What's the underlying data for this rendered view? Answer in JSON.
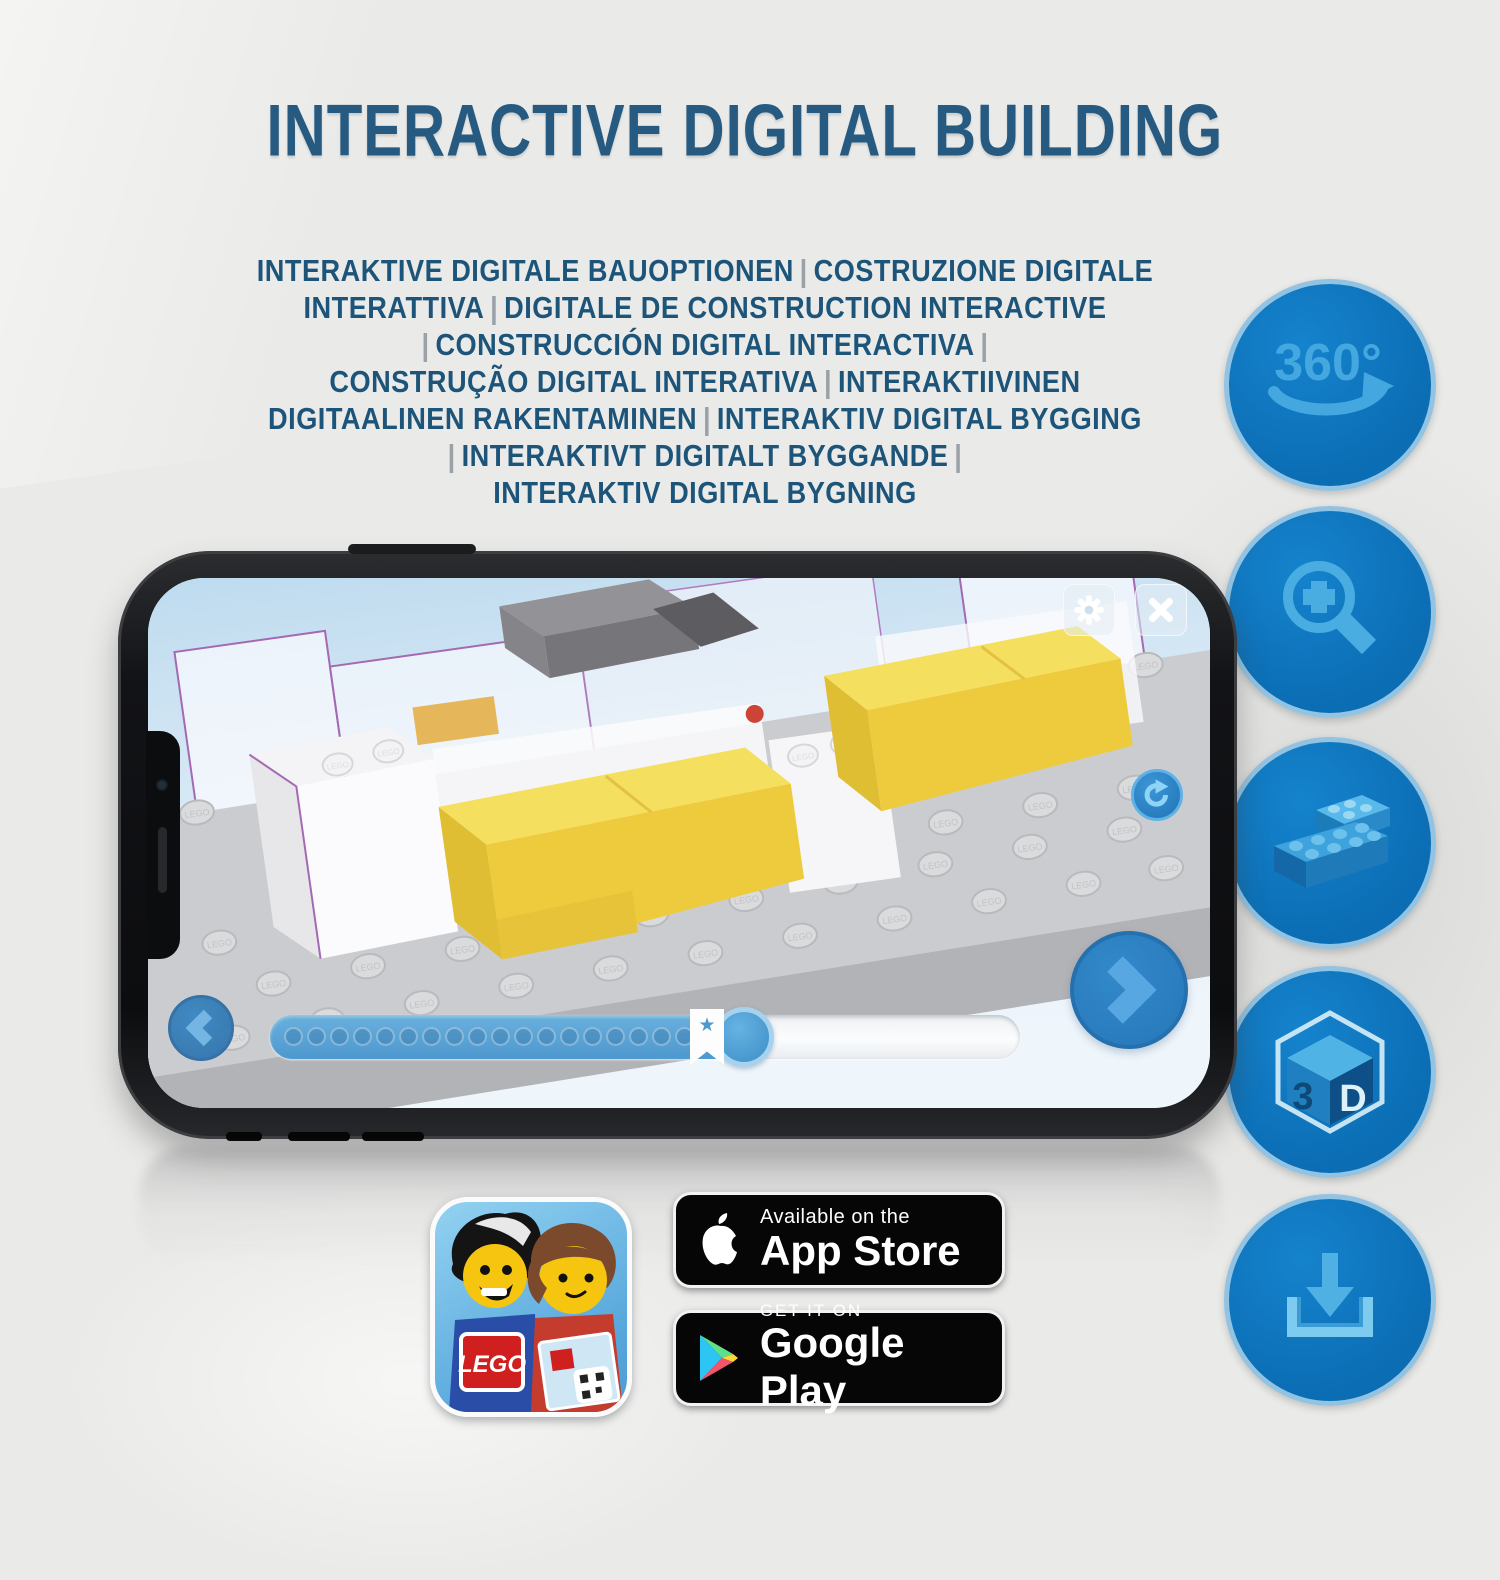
{
  "title": "INTERACTIVE DIGITAL BUILDING",
  "subtitle_lines": [
    "INTERAKTIVE DIGITALE BAUOPTIONEN | COSTRUZIONE DIGITALE",
    "INTERATTIVA | DIGITALE DE CONSTRUCTION INTERACTIVE",
    "| CONSTRUCCIÓN DIGITAL INTERACTIVA |",
    "CONSTRUÇÃO DIGITAL INTERATIVA | INTERAKTIIVINEN",
    "DIGITAALINEN RAKENTAMINEN | INTERAKTIV DIGITAL BYGGING",
    "| INTERAKTIVT DIGITALT BYGGANDE |",
    "INTERAKTIV DIGITAL BYGNING"
  ],
  "feature_icons": [
    {
      "name": "rotate-360-icon",
      "label": "360°"
    },
    {
      "name": "zoom-in-icon",
      "label": ""
    },
    {
      "name": "brick-icon",
      "label": ""
    },
    {
      "name": "3d-view-icon",
      "label_left": "3",
      "label_right": "D"
    },
    {
      "name": "download-icon",
      "label": ""
    }
  ],
  "phone": {
    "screen": {
      "stud_text": "LEGO",
      "progress": {
        "dots": 19,
        "fill_percent": 63,
        "bookmark_percent": 42,
        "bookmark_glyph": "★"
      }
    }
  },
  "badges": {
    "app_store": {
      "line1": "Available on the",
      "line2": "App Store"
    },
    "google_play": {
      "line1": "GET IT ON",
      "line2": "Google Play"
    },
    "lego_patch": "LEGO"
  },
  "colors": {
    "headline_blue": "#265a80",
    "subtitle_blue": "#1d5479",
    "circle_blue": "#0e78c0",
    "circle_ring": "#93c3e2",
    "glyph_blue": "#45a7e0",
    "screen_sky": "#c2ddf0",
    "brick_yellow": "#eecb3d",
    "plate_gray": "#cbccd0",
    "badge_black": "#060606"
  }
}
